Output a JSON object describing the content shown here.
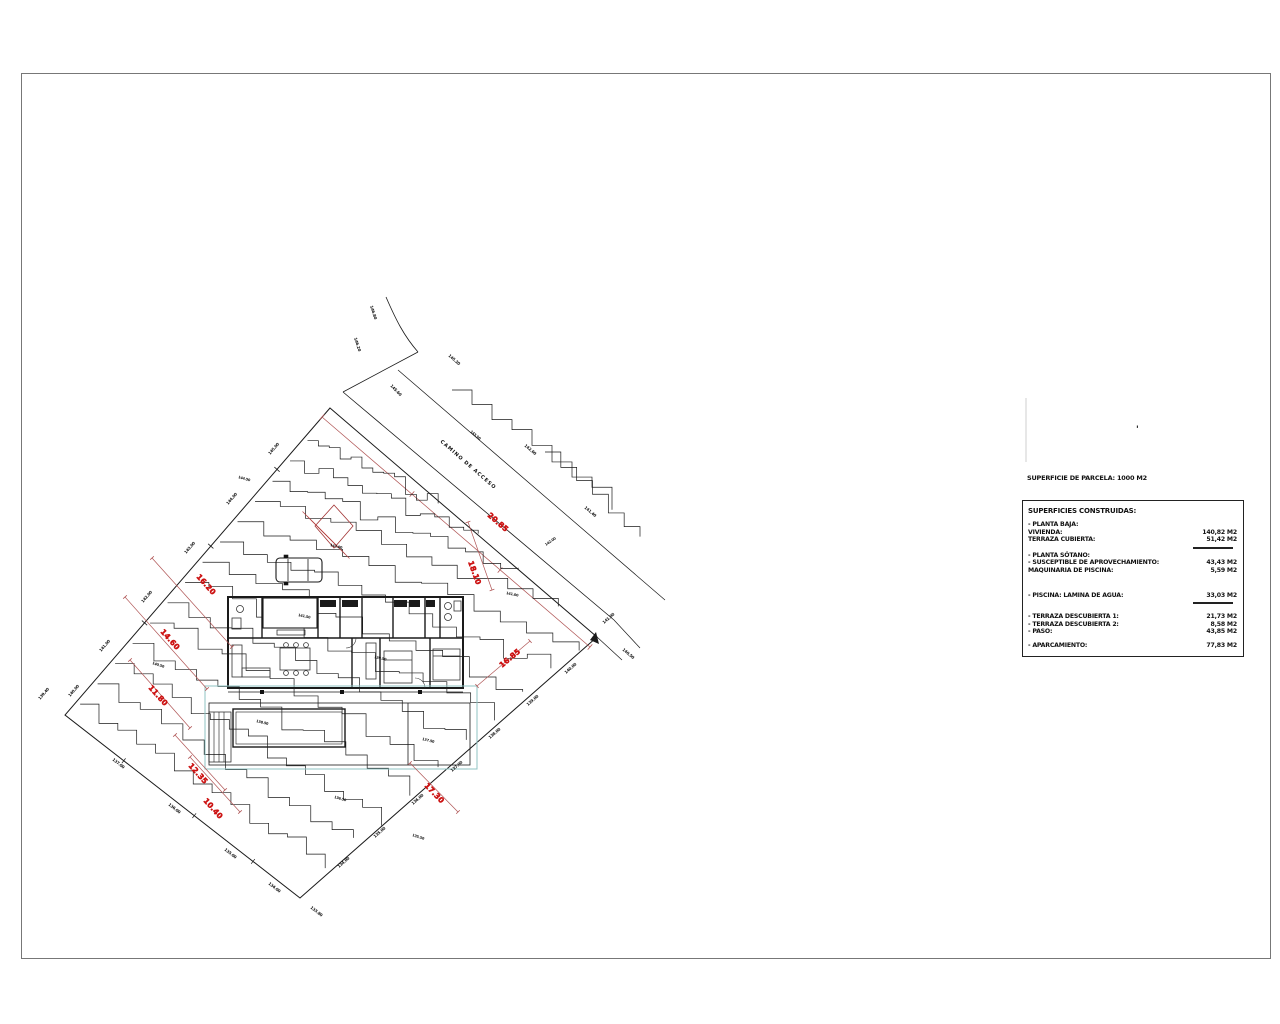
{
  "colors": {
    "line": "#1a1a1a",
    "dim_line": "#b05555",
    "red_label": "#cc1111",
    "cyan": "#8fc3c3",
    "border": "#777777"
  },
  "annotations": {
    "road_label": "CAMINO DE ACCESO",
    "corner_mark": "'"
  },
  "red_dims": [
    {
      "x": 160,
      "y": 632,
      "rot": 48,
      "text": "14.60"
    },
    {
      "x": 196,
      "y": 577,
      "rot": 48,
      "text": "16.20"
    },
    {
      "x": 148,
      "y": 688,
      "rot": 48,
      "text": "11.80"
    },
    {
      "x": 487,
      "y": 516,
      "rot": 41,
      "text": "20.85"
    },
    {
      "x": 468,
      "y": 562,
      "rot": 70,
      "text": "18.10"
    },
    {
      "x": 502,
      "y": 668,
      "rot": -40,
      "text": "16.85"
    },
    {
      "x": 424,
      "y": 786,
      "rot": 46,
      "text": "17.30"
    },
    {
      "x": 188,
      "y": 766,
      "rot": 48,
      "text": "12.35"
    },
    {
      "x": 203,
      "y": 801,
      "rot": 48,
      "text": "10.40"
    }
  ],
  "elev_labels": [
    [
      270,
      455,
      -49,
      "145.00"
    ],
    [
      228,
      505,
      -49,
      "144.00"
    ],
    [
      186,
      554,
      -49,
      "143.00"
    ],
    [
      143,
      603,
      -49,
      "142.00"
    ],
    [
      101,
      652,
      -49,
      "141.00"
    ],
    [
      70,
      697,
      -49,
      "140.00"
    ],
    [
      566,
      674,
      -41,
      "140.00"
    ],
    [
      528,
      706,
      -41,
      "139.00"
    ],
    [
      490,
      739,
      -41,
      "138.00"
    ],
    [
      452,
      772,
      -41,
      "137.00"
    ],
    [
      413,
      805,
      -41,
      "136.00"
    ],
    [
      375,
      838,
      -41,
      "135.00"
    ],
    [
      339,
      868,
      -41,
      "134.00"
    ],
    [
      112,
      760,
      38,
      "137.00"
    ],
    [
      168,
      805,
      38,
      "136.00"
    ],
    [
      224,
      850,
      38,
      "135.00"
    ],
    [
      268,
      884,
      38,
      "134.00"
    ],
    [
      310,
      908,
      38,
      "133.80"
    ],
    [
      448,
      356,
      41,
      "145.20"
    ],
    [
      524,
      446,
      40,
      "142.60"
    ],
    [
      584,
      508,
      40,
      "141.40"
    ],
    [
      604,
      624,
      -41,
      "141.00"
    ],
    [
      622,
      650,
      40,
      "140.50"
    ],
    [
      370,
      306,
      72,
      "146.80"
    ],
    [
      354,
      338,
      72,
      "146.20"
    ],
    [
      390,
      386,
      46,
      "145.60"
    ],
    [
      40,
      700,
      -49,
      "139.40"
    ]
  ],
  "contour_labels": [
    [
      238,
      478,
      16,
      "144.50"
    ],
    [
      330,
      546,
      14,
      "143.00"
    ],
    [
      298,
      616,
      12,
      "141.50"
    ],
    [
      152,
      664,
      18,
      "140.50"
    ],
    [
      374,
      658,
      12,
      "139.50"
    ],
    [
      256,
      722,
      14,
      "138.50"
    ],
    [
      422,
      740,
      14,
      "137.50"
    ],
    [
      334,
      798,
      16,
      "136.50"
    ],
    [
      412,
      836,
      18,
      "135.50"
    ],
    [
      506,
      594,
      12,
      "141.00"
    ],
    [
      546,
      546,
      -35,
      "142.00"
    ],
    [
      470,
      432,
      40,
      "143.50"
    ]
  ],
  "summary": {
    "parcel_title": "SUPERFICIE DE PARCELA: 1000 M2",
    "box_title": "SUPERFICIES CONSTRUIDAS:",
    "rows": [
      {
        "label": "- PLANTA BAJA:",
        "value": "",
        "gap": 3
      },
      {
        "label": "VIVIENDA:",
        "value": "140,82 M2",
        "gap": 0
      },
      {
        "label": "TERRAZA CUBIERTA:",
        "value": "51,42 M2",
        "gap": 0,
        "rule_after": true
      },
      {
        "label": "- PLANTA SÓTANO:",
        "value": "",
        "gap": 2
      },
      {
        "label": "- SUSCEPTIBLE DE APROVECHAMIENTO:",
        "value": "43,43 M2",
        "gap": 0
      },
      {
        "label": "MAQUINARIA DE PISCINA:",
        "value": "5,59 M2",
        "gap": 0
      },
      {
        "label": "- PISCINA: LAMINA DE AGUA:",
        "value": "33,03 M2",
        "gap": 17,
        "rule_after": true
      },
      {
        "label": "- TERRAZA DESCUBIERTA 1:",
        "value": "21,73 M2",
        "gap": 9
      },
      {
        "label": "- TERRAZA DESCUBIERTA 2:",
        "value": "8,58 M2",
        "gap": 0
      },
      {
        "label": "- PASO:",
        "value": "43,85 M2",
        "gap": 0
      },
      {
        "label": "- APARCAMIENTO:",
        "value": "77,83 M2",
        "gap": 6
      }
    ]
  }
}
